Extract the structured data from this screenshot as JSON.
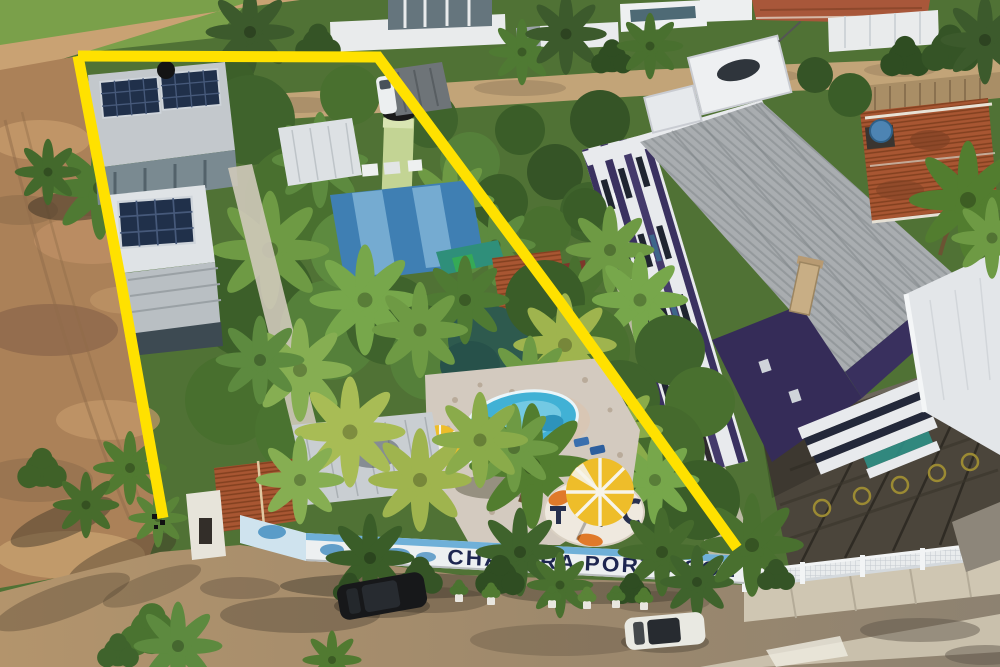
{
  "image": {
    "kind": "aerial-drone-photo",
    "subject": "Aerial view of a fenced pousada property outlined with a thick yellow boundary, beside a purple-and-white apartment building, palm trees, pool and dirt field",
    "width_px": 1000,
    "height_px": 667
  },
  "sign": {
    "text": "CHÁCARA PORTO SOL"
  },
  "boundary": {
    "right_points": "78,56 378,57 560,302 737,548",
    "left_points": "78,56 121,282 163,518",
    "stroke_px": 11
  },
  "palette": {
    "boundary-yellow": "#ffe100",
    "sign-navy": "#1d2650",
    "pool-blue": "#41b1d5",
    "building-purple": "#3a3160",
    "umbrella-yellow": "#eebd2a",
    "terracotta": "#b05a35",
    "vegetation-green": "#49702f",
    "dirt-tan": "#ab8158"
  },
  "notable_objects": [
    "yellow property boundary outline",
    "painted wall sign CHÁCARA PORTO SOL",
    "kidney-shaped swimming pool",
    "yellow pool umbrellas",
    "round mosaic terrace with fish motifs",
    "gatehouse with terracotta roof",
    "houses with rooftop solar panels",
    "light-green water tower",
    "purple and white apartment building with gray metal roof",
    "terracotta-roof neighbor house with blue water tank",
    "dark parking lot with painted circles",
    "white picket fence",
    "bare dirt field",
    "palm trees",
    "black parked car",
    "white parked hatchback"
  ]
}
